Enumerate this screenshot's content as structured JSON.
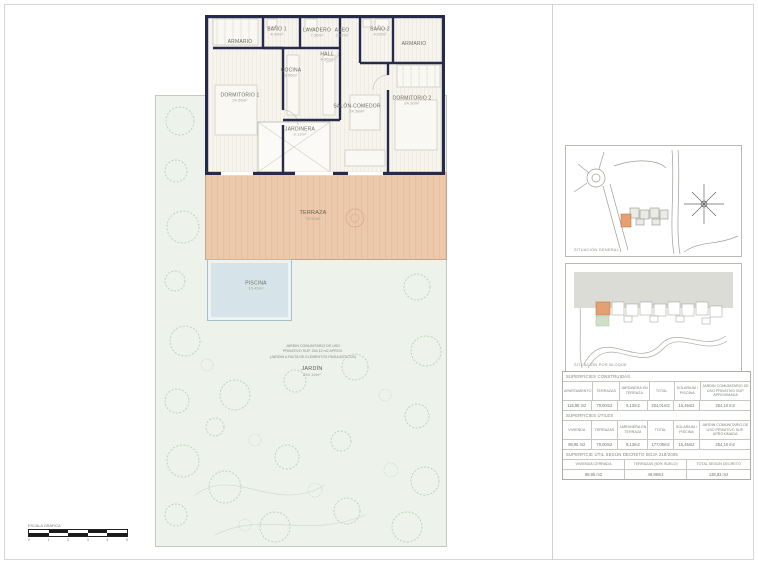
{
  "floor_plan": {
    "rooms": [
      {
        "label": "ARMARIO",
        "area": ""
      },
      {
        "label": "BAÑO 1",
        "area": "4.43m²"
      },
      {
        "label": "LAVADERO",
        "area": "7.36m²"
      },
      {
        "label": "ASEO",
        "area": "2.27m²"
      },
      {
        "label": "BAÑO 2",
        "area": "4.20m²"
      },
      {
        "label": "ARMARIO",
        "area": ""
      },
      {
        "label": "HALL",
        "area": "4.36m²"
      },
      {
        "label": "COCINA",
        "area": "9.56m²"
      },
      {
        "label": "DORMITORIO 1",
        "area": "24.55m²"
      },
      {
        "label": "SALÓN-COMEDOR",
        "area": "24.58m²"
      },
      {
        "label": "DORMITORIO 2",
        "area": "24.30m²"
      },
      {
        "label": "JARDINERA",
        "area": "9.13m²"
      }
    ],
    "terraza": {
      "label": "TERRAZA",
      "area": "79.00m²"
    },
    "piscina": {
      "label": "PISCINA",
      "area": "15.45m²"
    },
    "jardin": {
      "label": "JARDÍN",
      "area": "254.10m²",
      "note_line1": "JARDIN COMUNITARIO  DE USO",
      "note_line2": "PRIVATIVO SUP. 254,10 m2 APROX.",
      "note_line3": "(JARDIN A FALTA DE  ELEMENTOS PAISAJISTICOS)"
    }
  },
  "sidebar": {
    "map_general_caption": "SITUACIÓN  GENERAL",
    "map_block_caption": "SITUACIÓN  POR  BLOQUE",
    "tables": {
      "constructed": {
        "title": "SUPERFICIES  CONSTRUIDAS",
        "headers": [
          "APARTAMENTO",
          "TERRAZAS",
          "JARDINERA EN TERRAZA",
          "TOTAL",
          "SOLARIUM / PISCINA",
          "JARDIN COMUNITARIO DE USO PRIVATIVO SUP. APROXIMADA"
        ],
        "values": [
          "115,88 m2",
          "79,00m2",
          "9,13m2",
          "204,01m2",
          "15,45m2",
          "254,10 m2"
        ]
      },
      "useful": {
        "title": "SUPERFICIES  ÚTILES",
        "headers": [
          "VIVIENDA",
          "TERRAZAS",
          "JARDINERA EN TERRAZA",
          "TOTAL",
          "SOLARIUM / PISCINA",
          "JARDIN COMUNITARIO DE USO PRIVATIVO SUP. APROXIMADA"
        ],
        "values": [
          "88,95 m2",
          "79,00m2",
          "9,13m2",
          "177,08m2",
          "15,45m2",
          "254,10 m2"
        ]
      },
      "decree": {
        "title": "SUPERFICIE  ÚTIL  SEGÚN  DECRETO  BOJA  218/2005",
        "headers": [
          "VIVIENDA  CERRADA",
          "TERRAZAS (50% SUELO)",
          "TOTAL SEGÚN  DECRETO"
        ],
        "values": [
          "88,95  m2",
          "49,88m2",
          "138,83  m2"
        ]
      }
    }
  },
  "scale_bar": {
    "label": "ESCALA GRÁFICA",
    "ticks": [
      "0",
      "1",
      "2",
      "3",
      "4",
      "5"
    ]
  },
  "colors": {
    "wall": "#262b4c",
    "terrace": "#eac8a9",
    "pool": "#d6e4ea",
    "garden": "#edf2ea",
    "highlight": "#e5a071"
  }
}
